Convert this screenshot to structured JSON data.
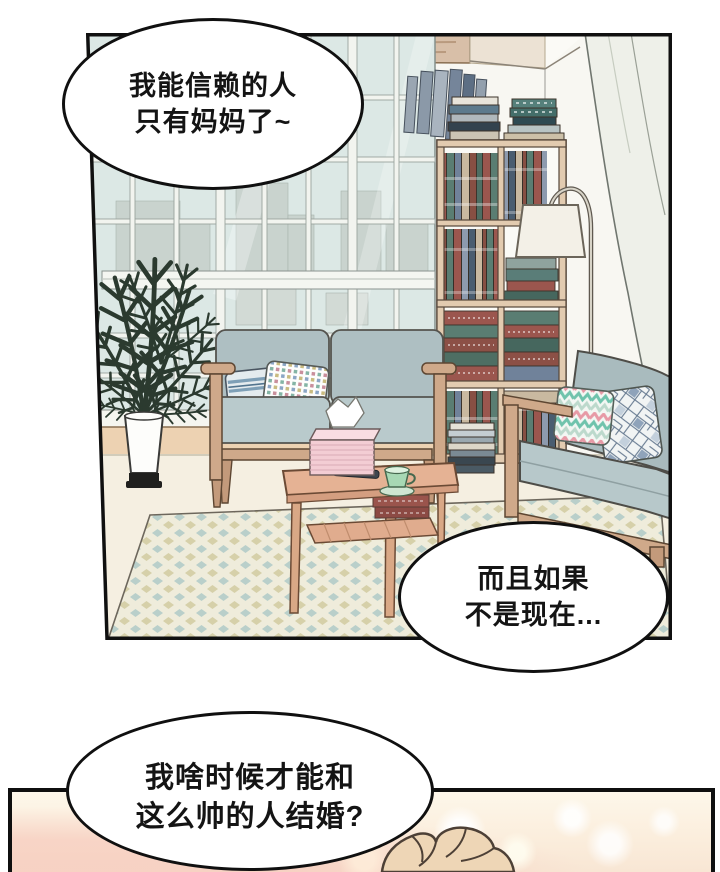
{
  "comic": {
    "speech_bubbles": [
      {
        "id": "bubble-1",
        "lines": [
          "我能信赖的人",
          "只有妈妈了~"
        ]
      },
      {
        "id": "bubble-2",
        "lines": [
          "而且如果",
          "不是现在..."
        ]
      },
      {
        "id": "bubble-3",
        "lines": [
          "我啥时候才能和",
          "这么帅的人结婚?"
        ]
      }
    ],
    "palette": {
      "panel_border": "#101010",
      "bubble_fill": "#ffffff",
      "bubble_border": "#101010",
      "text": "#141414",
      "wall": "#f8f7f2",
      "glass": "#dce8e5",
      "curtain": "#eef0e9",
      "sofa_cushion": "#aebfc2",
      "sofa_seat": "#b9cacc",
      "frame_wood": "#cfa98a",
      "shelf_wood": "#e2cbb0",
      "table_wood": "#e5b294",
      "rug_cream": "#efecdb",
      "rug_blue": "#b9cfca",
      "rug_tan": "#d6d0a9",
      "tissue_box": "#f3cdd4",
      "teacup": "#a7d8b4",
      "plant_green": "#2b3a2f",
      "floor": "#f5efe1",
      "bottom_panel_warm": "#fbeedd",
      "hair": "#eed6b6"
    }
  }
}
